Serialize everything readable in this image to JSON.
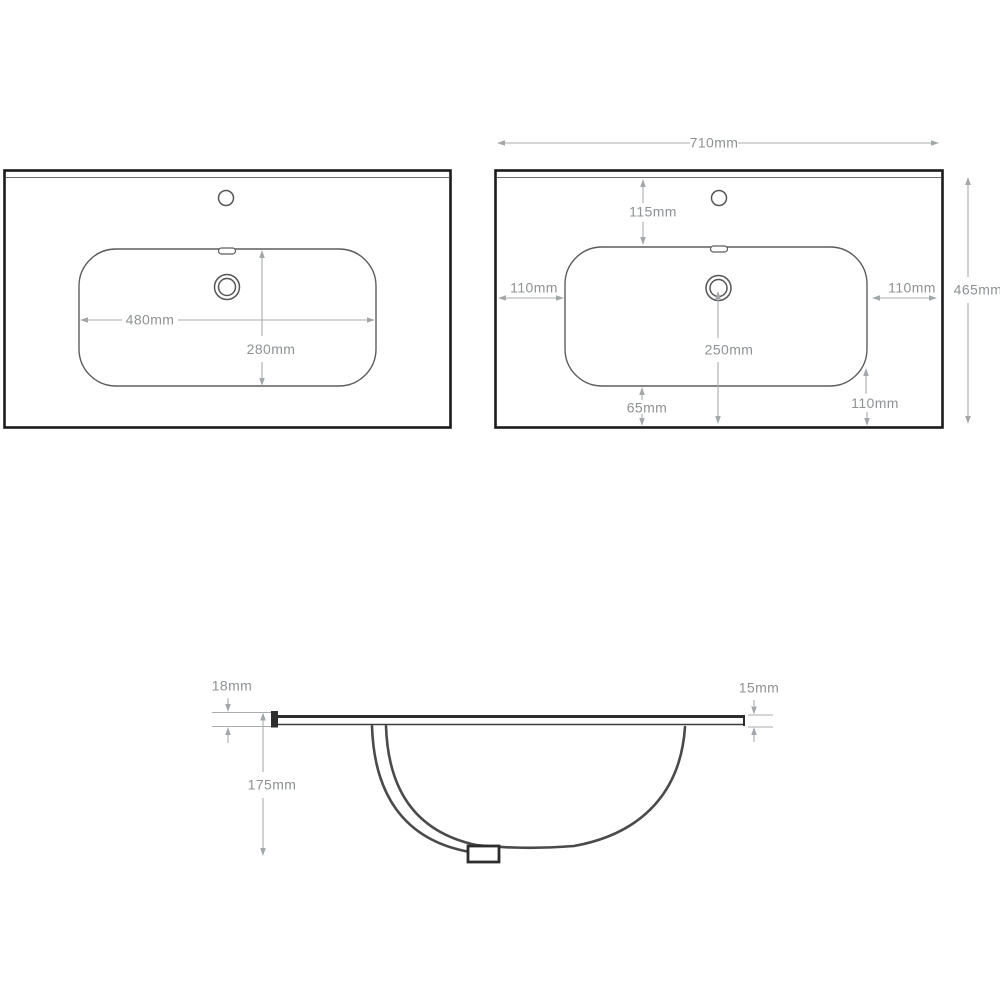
{
  "palette": {
    "background": "#ffffff",
    "outline_dark": "#1b1b1b",
    "outline_mid": "#565656",
    "dim_line": "#a8acae",
    "dim_text": "#8e9294"
  },
  "dimensions": {
    "view_left": {
      "basin_width": "480mm",
      "basin_depth": "280mm"
    },
    "view_right": {
      "overall_width": "710mm",
      "tap_offset": "115mm",
      "margin_left": "110mm",
      "margin_right": "110mm",
      "overall_depth": "465mm",
      "drain_to_front": "250mm",
      "bowl_to_front": "65mm",
      "corner_to_front": "110mm"
    },
    "view_section": {
      "thickness_left": "18mm",
      "thickness_right": "15mm",
      "bowl_depth": "175mm"
    }
  }
}
